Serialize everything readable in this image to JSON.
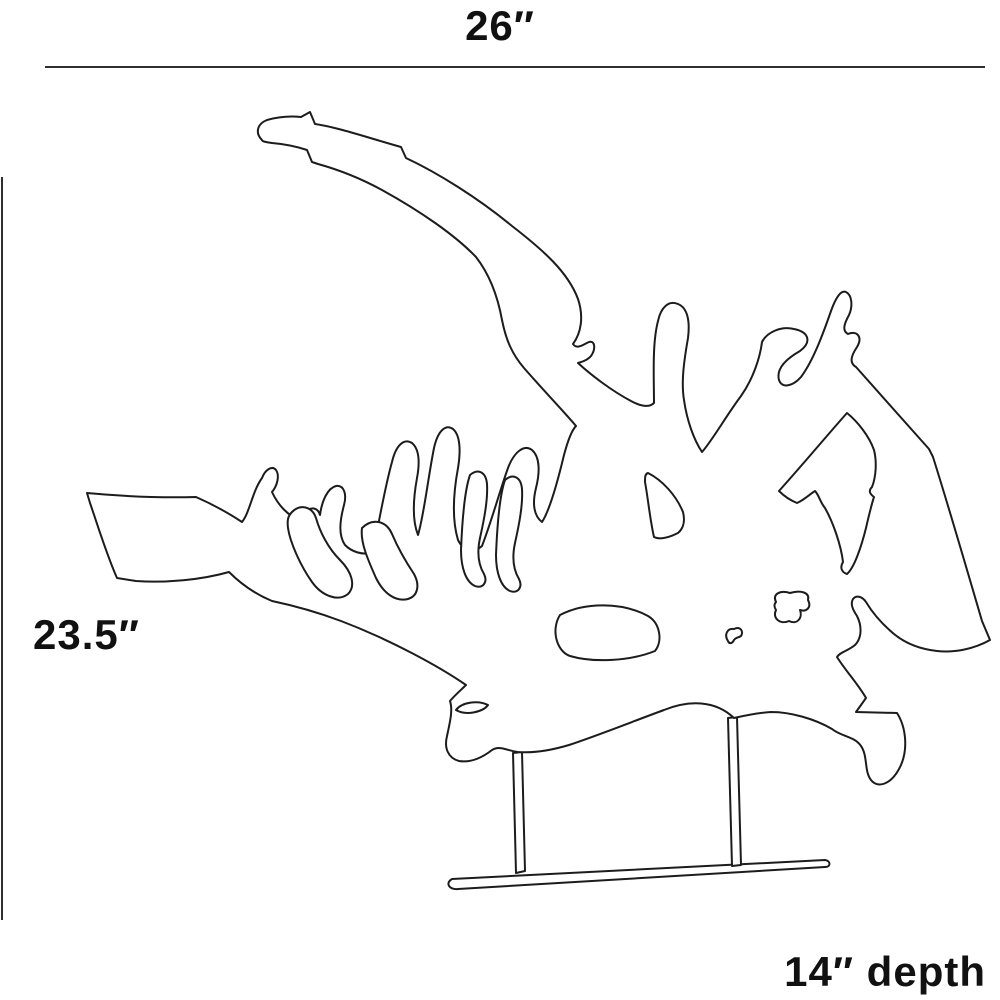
{
  "diagram": {
    "title": "sculpture-dimension-diagram",
    "subject": "organic driftwood sculpture on stand",
    "annotations": {
      "width_label": "26″",
      "height_label": "23.5″",
      "depth_label": "14″ depth"
    },
    "dimensions": {
      "width_value": "26",
      "height_value": "23.5",
      "depth_value": "14",
      "unit": "inches"
    },
    "colors": {
      "background": "#ffffff",
      "line": "#1c1c1c",
      "dimension_line": "#2f2f2f",
      "text": "#111111"
    }
  }
}
